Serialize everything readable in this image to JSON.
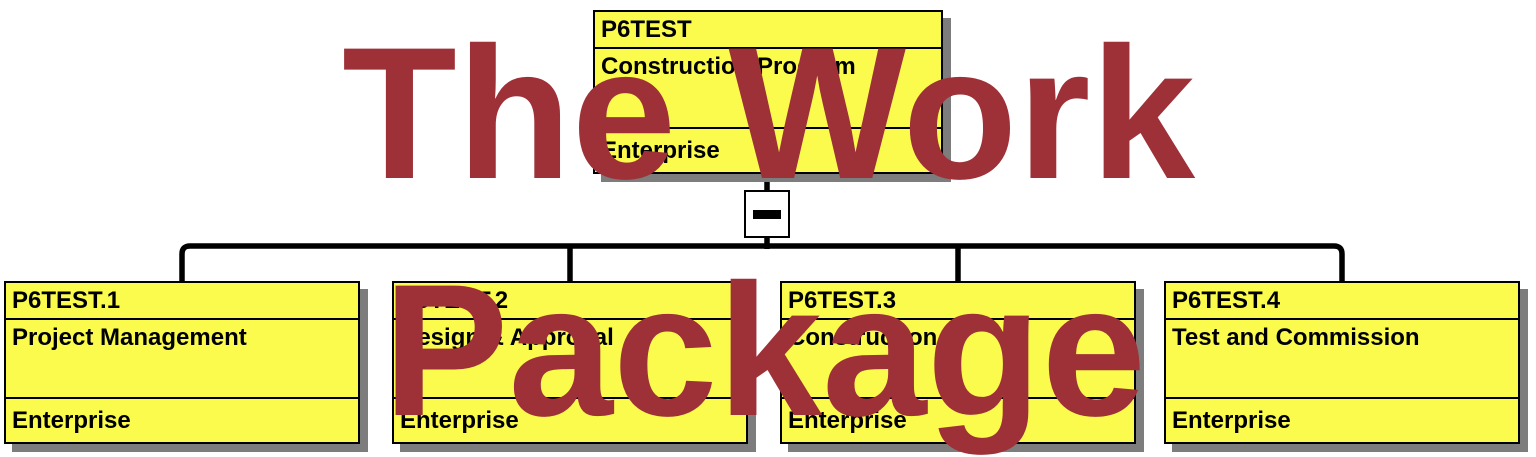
{
  "watermark": {
    "line1": "The Work",
    "line2": "Package"
  },
  "root_node": {
    "code": "P6TEST",
    "name": "Construction Program",
    "responsible": "Enterprise"
  },
  "collapse_button": {
    "icon": "minus-icon",
    "state": "expanded"
  },
  "child_nodes": [
    {
      "code": "P6TEST.1",
      "name": "Project Management",
      "responsible": "Enterprise"
    },
    {
      "code": "P6TEST.2",
      "name": "Design & Approval",
      "responsible": "Enterprise"
    },
    {
      "code": "P6TEST.3",
      "name": "Construction",
      "responsible": "Enterprise"
    },
    {
      "code": "P6TEST.4",
      "name": "Test and Commission",
      "responsible": "Enterprise"
    }
  ],
  "colors": {
    "background": "#ffffff",
    "node_fill": "#FBFB4E",
    "node_border": "#000000",
    "node_text": "#000000",
    "shadow": "#7d7d7d",
    "connector": "#000000",
    "watermark": "#9E3138"
  }
}
